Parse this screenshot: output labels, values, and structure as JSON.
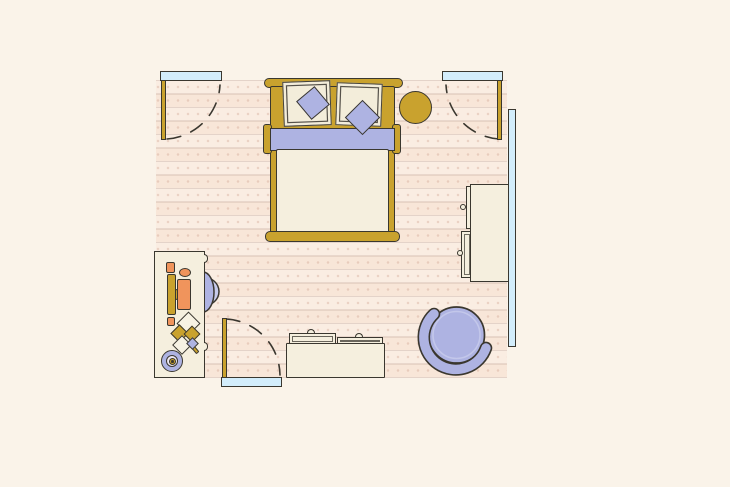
{
  "page": {
    "kind": "bedroom-floor-plan-illustration",
    "visible_text": ""
  },
  "colors": {
    "bg": "#faf3e9",
    "floor": "#f8e6d8",
    "floor-line": "#d8c1b5",
    "outline": "#3a372f",
    "gold": "#c9a22e",
    "peri": "#aeb3e2",
    "peri-light": "#c7cbec",
    "cream": "#f5efde",
    "pillow": "#f3edda",
    "orange": "#f0945c",
    "blue": "#d3edfb"
  },
  "room": {
    "openings": [
      {
        "name": "doorway-top-left",
        "type": "door",
        "swing": "into-room"
      },
      {
        "name": "doorway-top-right",
        "type": "door",
        "swing": "into-room"
      },
      {
        "name": "doorway-bottom",
        "type": "door",
        "swing": "into-room"
      },
      {
        "name": "window-right-wall",
        "type": "window"
      }
    ],
    "furniture": [
      {
        "name": "bed",
        "parts": [
          "headboard",
          "pillow-left",
          "pillow-right",
          "accent-pillow-left",
          "accent-pillow-right",
          "blanket-band",
          "duvet",
          "footboard"
        ]
      },
      {
        "name": "round-side-stool"
      },
      {
        "name": "dresser",
        "parts": [
          "drawer-top",
          "drawer-bottom",
          "knobs"
        ]
      },
      {
        "name": "round-lounge-chair"
      },
      {
        "name": "storage-bench",
        "parts": [
          "tray-left",
          "tray-right"
        ]
      },
      {
        "name": "desk",
        "parts": [
          "stationery",
          "papers",
          "fan"
        ]
      },
      {
        "name": "desk-chair"
      }
    ]
  }
}
